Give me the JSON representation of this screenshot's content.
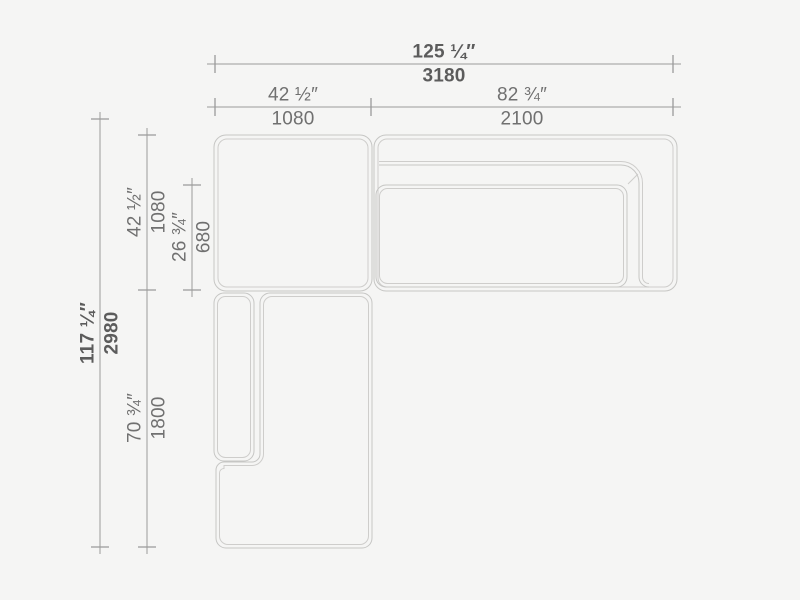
{
  "drawing": {
    "kind": "sectional-sofa-top-view-dimension-drawing",
    "units": [
      "inches",
      "mm"
    ]
  },
  "colors": {
    "background": "#f5f5f4",
    "furniture_line": "#c6c6c4",
    "furniture_line_inner": "#cecdcb",
    "dimension_line": "#9b9b9a",
    "label_text": "#707070",
    "label_text_bold": "#5c5c5c"
  },
  "dims": {
    "h_overall": {
      "in": "125 ¼″",
      "mm": "3180"
    },
    "h_left": {
      "in": "42 ½″",
      "mm": "1080"
    },
    "h_right": {
      "in": "82 ¾″",
      "mm": "2100"
    },
    "v_overall": {
      "in": "117 ¼″",
      "mm": "2980"
    },
    "v_top": {
      "in": "42 ½″",
      "mm": "1080"
    },
    "v_seat": {
      "in": "26 ¾″",
      "mm": "680"
    },
    "v_chaise": {
      "in": "70 ¾″",
      "mm": "1800"
    }
  }
}
